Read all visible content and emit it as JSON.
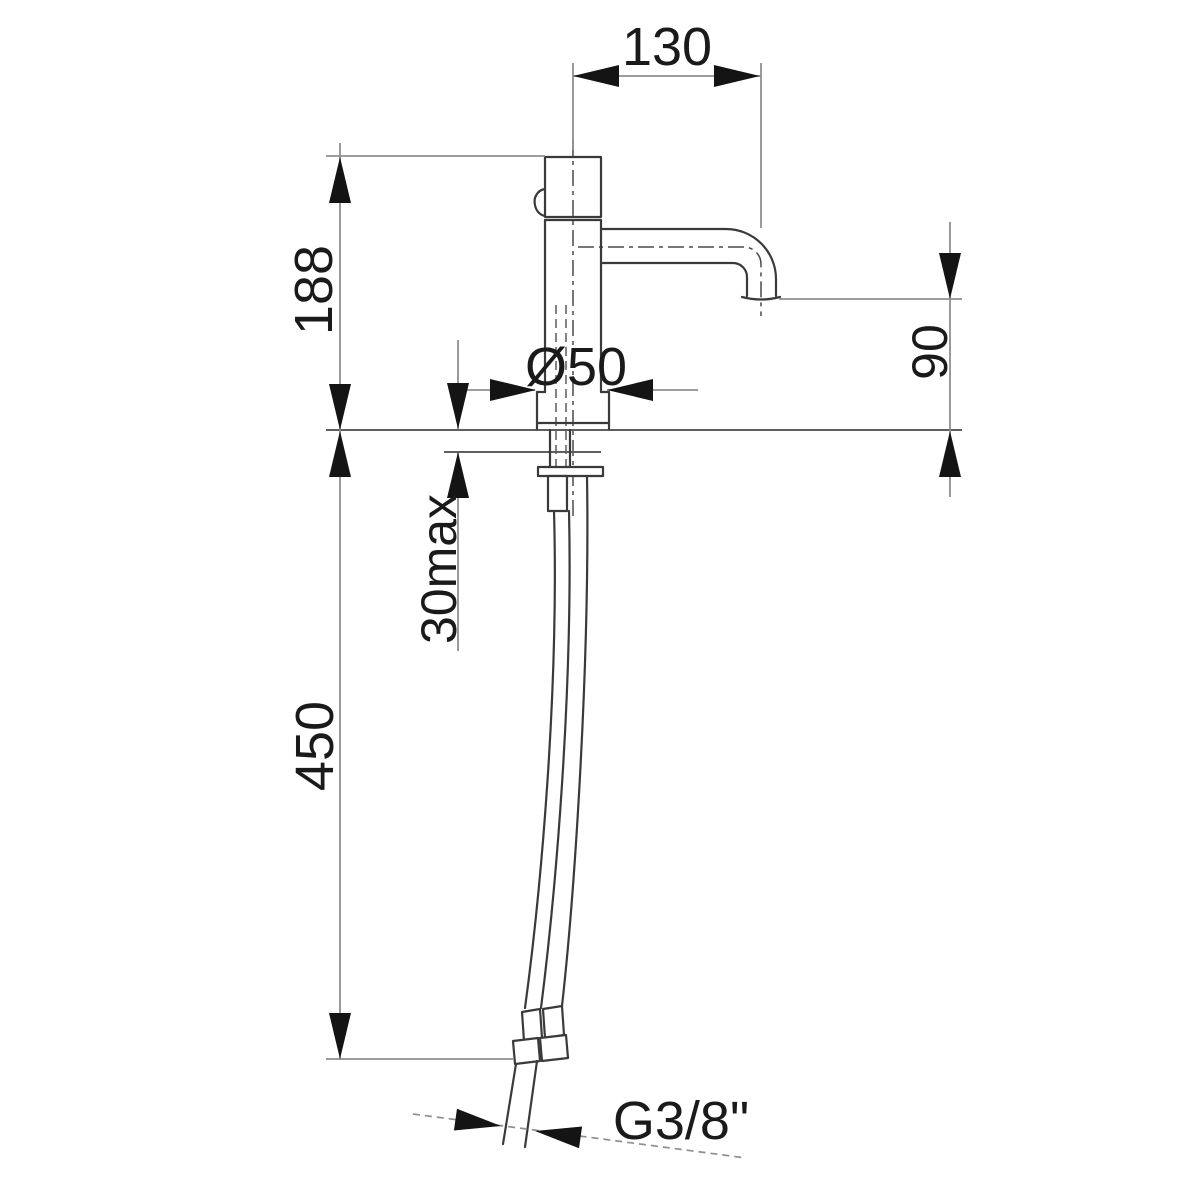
{
  "drawing": {
    "title": "basin tap technical dimension drawing",
    "view": "side elevation with deck section and flexible supply hose",
    "labels": {
      "spout_reach": "130",
      "height_above_deck": "188",
      "base_diameter": "Ø50",
      "spout_height": "90",
      "max_deck_thickness": "30max",
      "hose_length": "450",
      "connection_thread": "G3/8\""
    },
    "colors": {
      "background": "#ffffff",
      "outline": "#3a3a3a",
      "dimension": "#8f8f8f",
      "arrow": "#141414",
      "text": "#1a1a1a",
      "centerline": "#4a4a4a",
      "hidden": "#5a5a5a",
      "deck_line": "#5f5f5f"
    }
  }
}
